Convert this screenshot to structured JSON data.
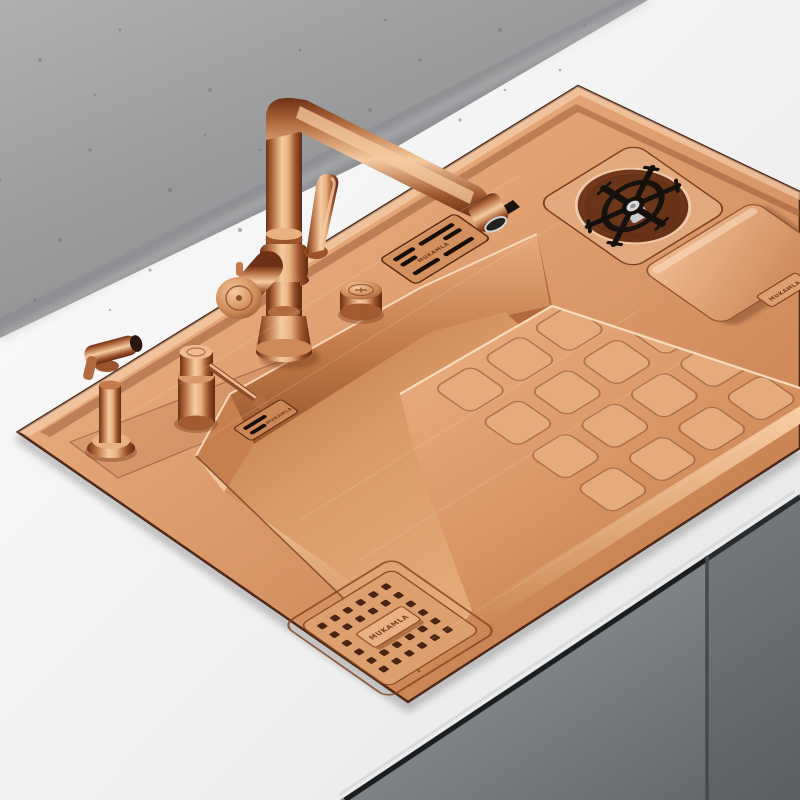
{
  "scene": {
    "type": "product-photo",
    "description": "Brushed rose-gold copper multifunction kitchen workstation sink mounted in a white countertop against a grey concrete wall, with grey cabinet doors below",
    "wall": "grey concrete with speckle texture",
    "countertop": "white stone",
    "cabinet": "grey flat-panel doors with center seam"
  },
  "brand": {
    "engraving": "MUKAMLA"
  },
  "objects": {
    "faucet": "L-shaped rose-gold mixer faucet with top lever and round side handle",
    "side_sprayer": "angled pull sprayer with trigger",
    "soap_dispenser": "built-in soap dispenser with swing spout",
    "control_knob": "round deck knob",
    "overflow_grill": "slotted deck vent plate",
    "wall_vent": "small slotted overflow plate on basin wall",
    "cup_washer": "black six-spoke glass rinser in round recess",
    "cover_plate": "square compartment cover with pull tab",
    "drainboard": "raised platform embossed with rounded squares",
    "drain_cover": "perforated square drain plate with pull tab"
  },
  "colors": {
    "copper_highlight": "#f9d6b4",
    "copper_light": "#edb58e",
    "copper_mid": "#d69267",
    "copper_deep": "#b06a42",
    "copper_shadow": "#8e4e2e",
    "outline": "#4f2a1a",
    "wall_grey": "#999a9b",
    "counter_white": "#f4f4f4",
    "cabinet_grey": "#83888c",
    "rinser_black": "#1a1a1a",
    "chrome": "#d9dadc"
  }
}
